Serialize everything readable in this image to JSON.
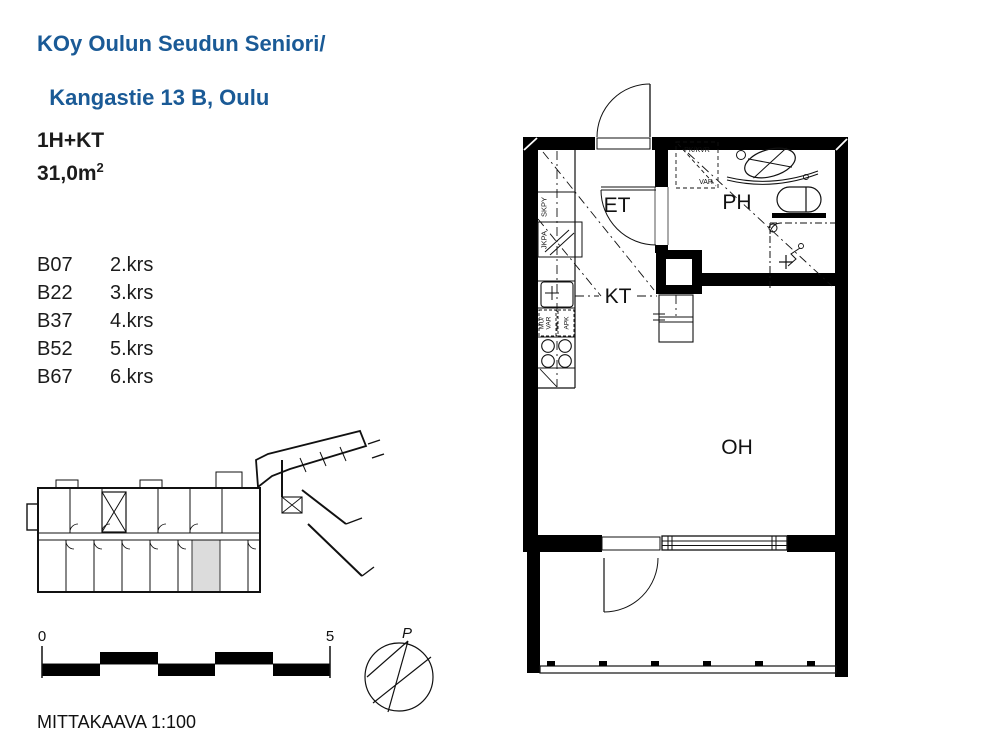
{
  "colors": {
    "accent_blue": "#1a5a96",
    "unit_highlight": "#dcdcdc",
    "linework": "#111111"
  },
  "header": {
    "title_line1": "KOy Oulun Seudun Seniori/",
    "title_line2": "Kangastie 13 B, Oulu"
  },
  "apartment": {
    "layout_type": "1H+KT",
    "area_value": "31,0m",
    "area_superscript": "2"
  },
  "units": [
    {
      "id": "B07",
      "floor": "2.krs"
    },
    {
      "id": "B22",
      "floor": "3.krs"
    },
    {
      "id": "B37",
      "floor": "4.krs"
    },
    {
      "id": "B52",
      "floor": "5.krs"
    },
    {
      "id": "B67",
      "floor": "6.krs"
    }
  ],
  "floor_plan": {
    "rooms": {
      "entrance": "ET",
      "kitchenette": "KT",
      "bathroom": "PH",
      "living_room": "OH"
    },
    "labels": {
      "skpy": "SKPY",
      "jkpa": "JKPA",
      "mu": "MU/",
      "var_kitchen": "VAR",
      "apk": "APK",
      "pk_kvr": "PK/KVR",
      "var_bathroom": "VAR"
    }
  },
  "scale_bar": {
    "start_label": "0",
    "end_label": "5",
    "caption": "MITTAKAAVA 1:100"
  },
  "compass": {
    "north_label": "P"
  }
}
